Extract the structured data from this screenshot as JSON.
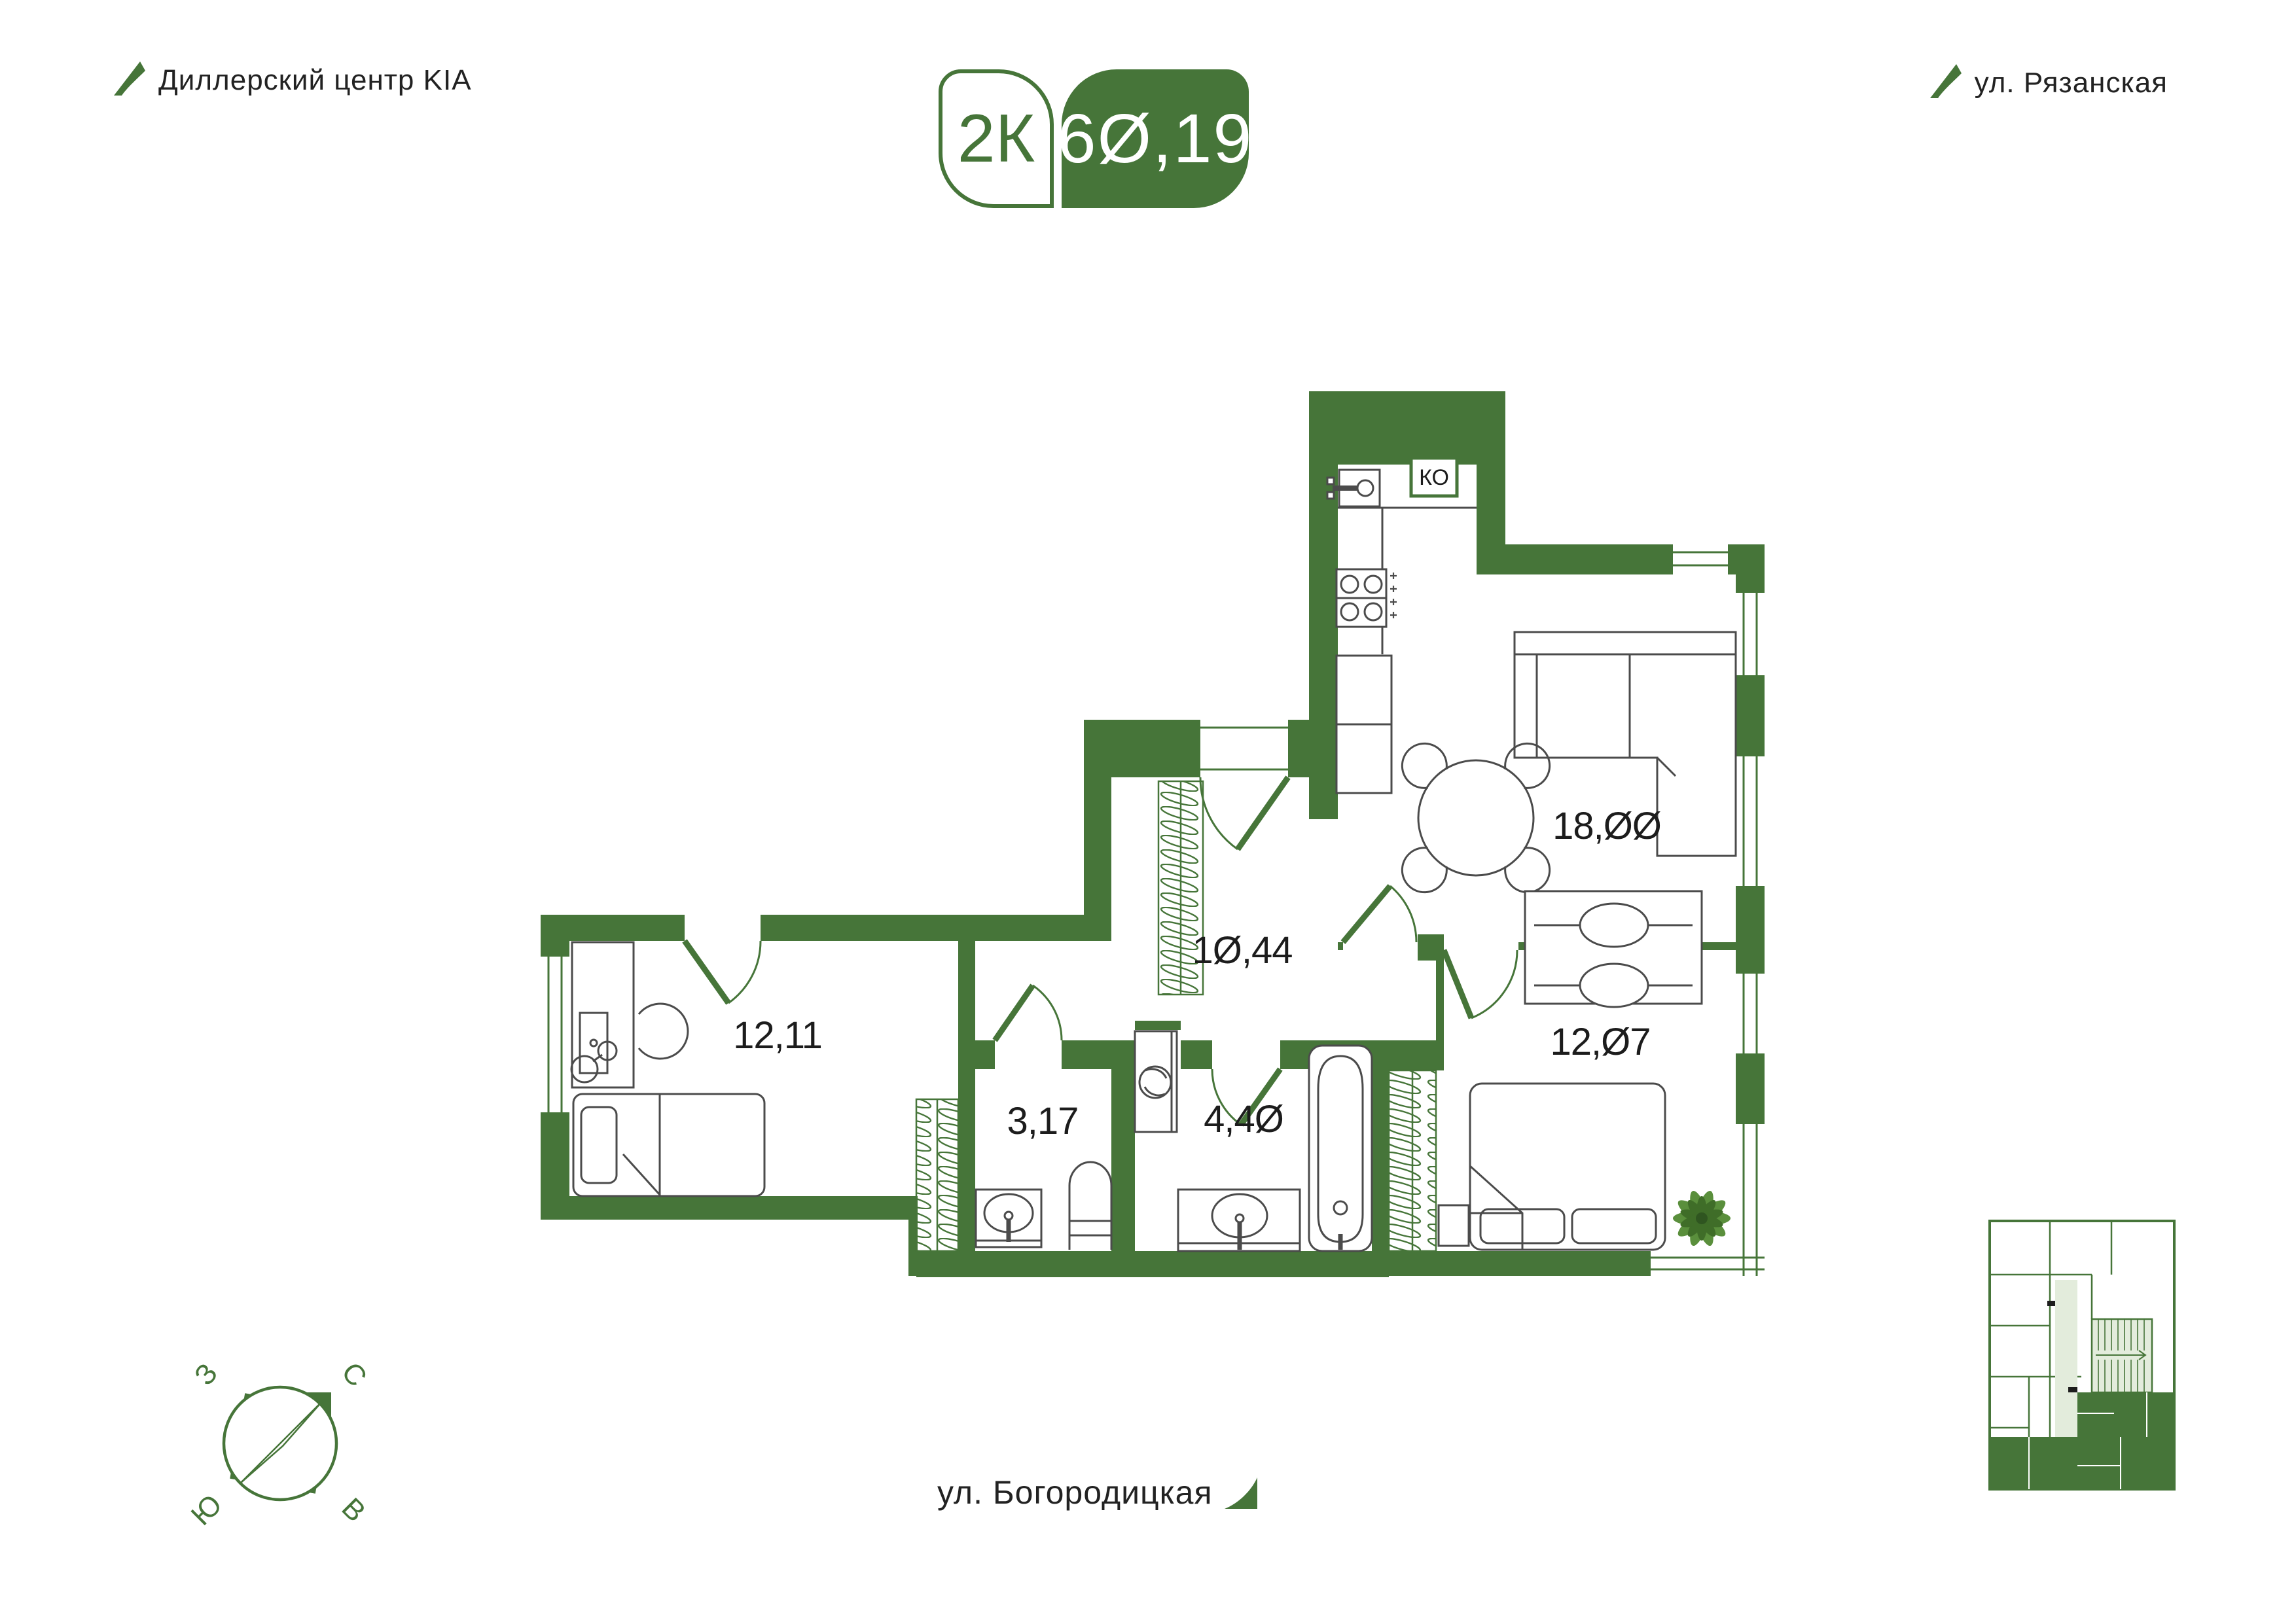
{
  "header": {
    "dealer": "Диллерский центр KIA",
    "street_right": "ул. Рязанская"
  },
  "badge": {
    "rooms": "2К",
    "area": "60,19"
  },
  "plan": {
    "vent": "КО",
    "areas": {
      "living_kitchen": "18,00",
      "corridor": "10,44",
      "bedroom": "12,07",
      "room2": "12,11",
      "wc": "3,17",
      "bathroom": "4,40"
    }
  },
  "footer": {
    "street": "ул. Богородицкая"
  },
  "compass": {
    "north": "С",
    "south": "Ю",
    "west": "З",
    "east": "В"
  },
  "colors": {
    "wall_green": "#467539",
    "light_fill": "#e3ecdc"
  }
}
